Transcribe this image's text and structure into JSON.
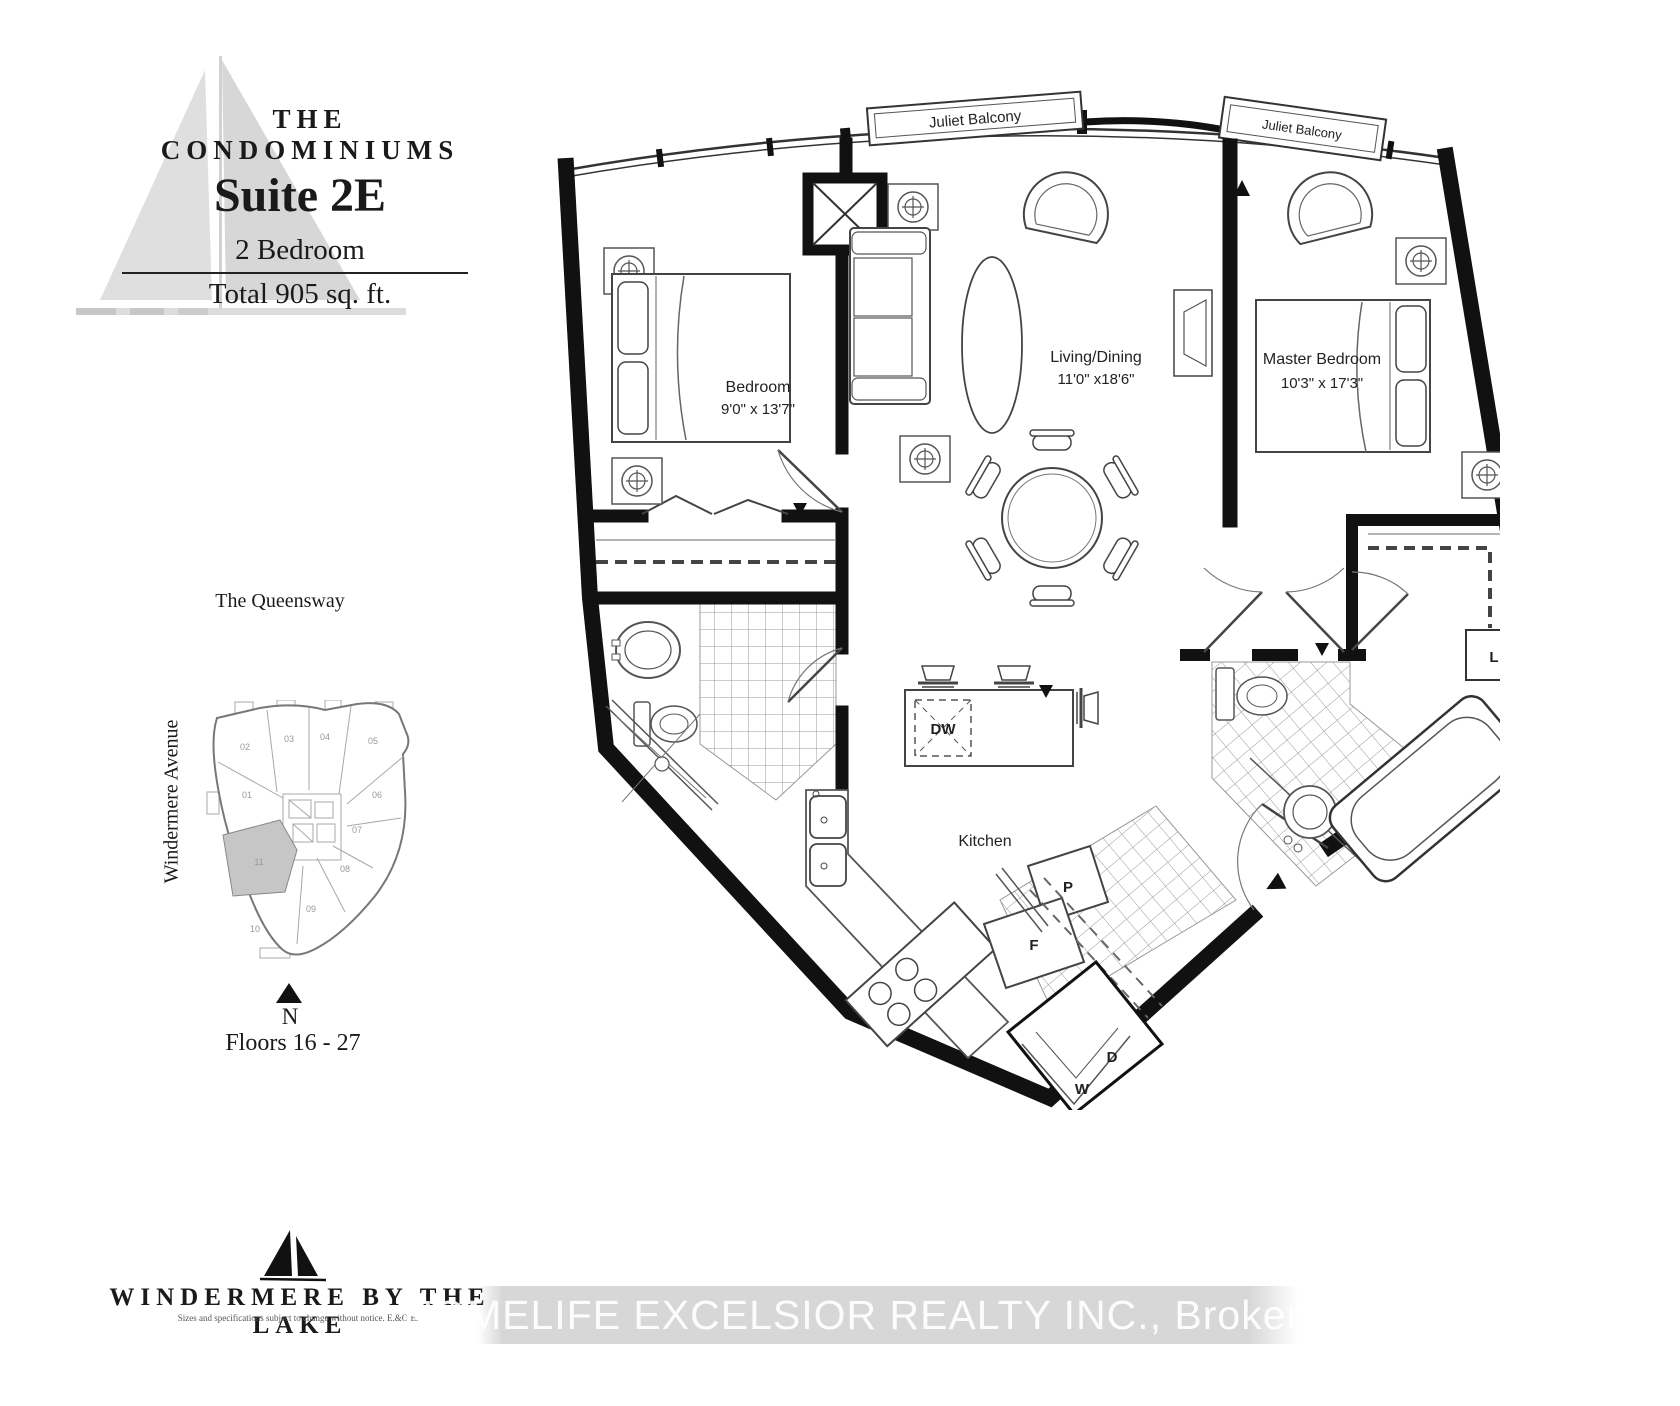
{
  "header": {
    "brand": "THE CONDOMINIUMS",
    "suite": "Suite 2E",
    "type": "2 Bedroom",
    "area": "Total 905 sq. ft."
  },
  "keyplan": {
    "street_top": "The Queensway",
    "street_left": "Windermere Avenue",
    "north": "N",
    "floors": "Floors 16 - 27",
    "highlight": "11",
    "units": [
      "02",
      "03",
      "04",
      "05",
      "01",
      "06",
      "07",
      "08",
      "09",
      "10"
    ]
  },
  "plan": {
    "balcony": "Juliet Balcony",
    "bedroom": {
      "name": "Bedroom",
      "dims": "9'0\" x 13'7\""
    },
    "living": {
      "name": "Living/Dining",
      "dims": "11'0\" x18'6\""
    },
    "master": {
      "name": "Master Bedroom",
      "dims": "10'3\" x 17'3\""
    },
    "kitchen": "Kitchen",
    "dw": "DW",
    "p": "P",
    "f": "F",
    "d": "D",
    "w": "W",
    "l": "L"
  },
  "footer": {
    "brand": "WINDERMERE BY THE LAKE",
    "disclaimer": "Sizes and specifications subject to change without notice.  E.&O.E.",
    "watermark": "HOMELIFE EXCELSIOR REALTY INC., Brokerage"
  }
}
